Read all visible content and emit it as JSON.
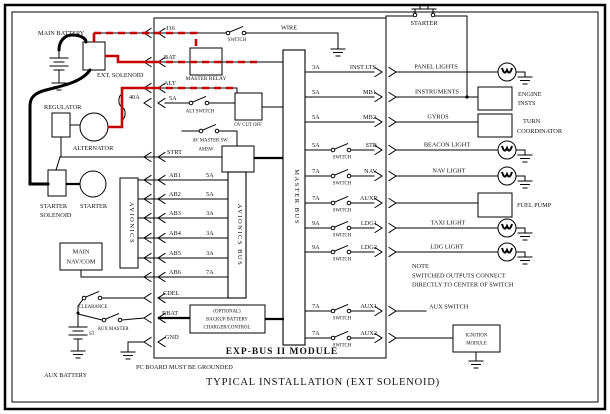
{
  "top": {
    "switch": "SWITCH",
    "wire": "WIRE",
    "starter": "STARTER"
  },
  "module": {
    "name": "EXP-BUS II MODULE",
    "master_relay": "MASTER RELAY",
    "master_bus": "MASTER BUS",
    "avionics_bus": "AVIONICS BUS",
    "ov_cutoff": "OV CUT OFF",
    "av_master_sw": "AV MASTER SW",
    "amsw": "AMSW",
    "switch_label": "SWITCH",
    "inputs": {
      "j16": "J16",
      "bat": "BAT",
      "alt": "ALT",
      "alt_fuse": "5A",
      "alt_switch": "ALT SWITCH",
      "strt": "STRT",
      "cdel": "CDEL",
      "rbat": "RBAT",
      "gnd": "GND"
    },
    "backup_battery": [
      "(OPTIONAL)",
      "BACKUP BATTERY",
      "CHARGER/CONTROL"
    ],
    "avionics_rows": [
      {
        "label": "AB1",
        "amp": "5A"
      },
      {
        "label": "AB2",
        "amp": "5A"
      },
      {
        "label": "AB3",
        "amp": "3A"
      },
      {
        "label": "AB4",
        "amp": "3A"
      },
      {
        "label": "AB5",
        "amp": "3A"
      },
      {
        "label": "AB6",
        "amp": "7A"
      }
    ],
    "outputs": [
      {
        "amp": "3A",
        "label": "INST LTS"
      },
      {
        "amp": "5A",
        "label": "MB1"
      },
      {
        "amp": "5A",
        "label": "MB2"
      },
      {
        "amp": "5A",
        "label": "STB"
      },
      {
        "amp": "7A",
        "label": "NAV"
      },
      {
        "amp": "7A",
        "label": "AUXP"
      },
      {
        "amp": "9A",
        "label": "LDG1"
      },
      {
        "amp": "9A",
        "label": "LDG2"
      },
      {
        "amp": "7A",
        "label": "AUX1"
      },
      {
        "amp": "7A",
        "label": "AUX2"
      }
    ]
  },
  "left": {
    "main_battery": "MAIN BATTERY",
    "ext_solenoid": "EXT. SOLENOID",
    "regulator": "REGULATOR",
    "alternator": "ALTERNATOR",
    "alternator_fuse": "40A",
    "starter_solenoid_line1": "STARTER",
    "starter_solenoid_line2": "SOLENOID",
    "starter": "STARTER",
    "avionics": "AVIONICS",
    "main_navcom_line1": "MAIN",
    "main_navcom_line2": "NAV/COM",
    "clearance": "CLEARANCE",
    "aux_master": "AUX MASTER",
    "st": "ST",
    "aux_battery": "AUX BATTERY"
  },
  "right": {
    "panel_lights": "PANEL LIGHTS",
    "instruments": "INSTRUMENTS",
    "engine_insts_line1": "ENGINE",
    "engine_insts_line2": "INSTS",
    "gyros": "GYROS",
    "turn_coordinator_line1": "TURN",
    "turn_coordinator_line2": "COORDINATOR",
    "beacon_light": "BEACON LIGHT",
    "nav_light": "NAV LIGHT",
    "fuel_pump": "FUEL PUMP",
    "taxi_light": "TAXI LIGHT",
    "ldg_light": "LDG LIGHT",
    "aux_switch": "AUX SWITCH",
    "ignition_line1": "IGNITION",
    "ignition_line2": "MODULE",
    "note": [
      "NOTE",
      "SWITCHED OUTPUTS CONNECT",
      "DIRECTLY TO CENTER OF SWITCH"
    ]
  },
  "footer": {
    "board_note": "PC BOARD MUST BE GROUNDED",
    "title": "TYPICAL INSTALLATION (EXT SOLENOID)"
  },
  "colors": {
    "wire": "#000000",
    "hot_wire": "#c80000"
  }
}
